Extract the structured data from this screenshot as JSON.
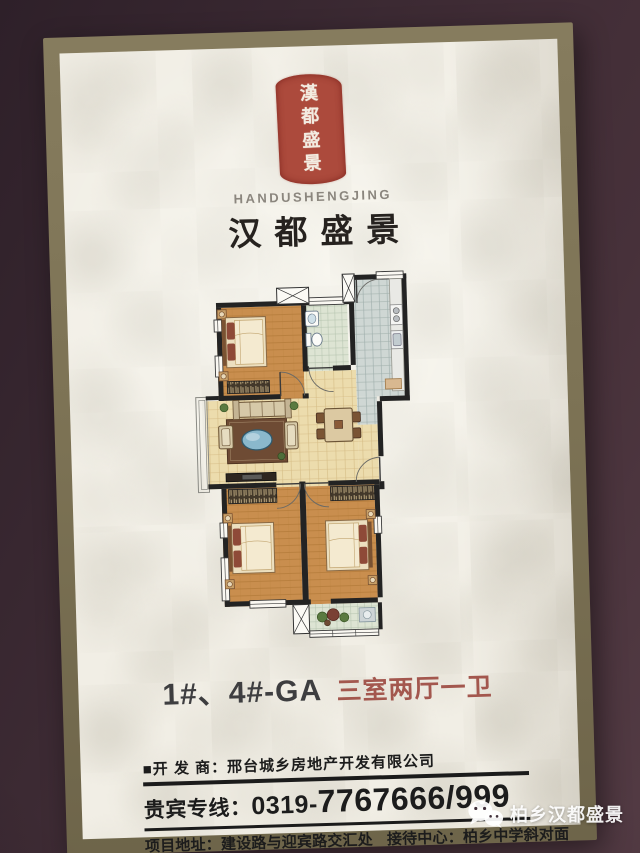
{
  "photo": {
    "background_color": "#3c2a33",
    "frame_color": "#7d7355",
    "paper_color": "#f1eee5"
  },
  "brand": {
    "seal_characters": [
      "漢",
      "都",
      "盛",
      "景"
    ],
    "seal_color": "#b04a3c",
    "latin_name": "HANDUSHENGJING",
    "calligraphy_name": "汉都盛景"
  },
  "unit": {
    "unit_label": "1#、4#-GA",
    "layout_label": "三室两厅一卫",
    "layout_color": "#a3574e"
  },
  "contact": {
    "developer_label": "■开 发 商：",
    "developer_name": "邢台城乡房地产开发有限公司",
    "hotline_label": "贵宾专线：",
    "hotline_area_code": "0319-",
    "hotline_number": "7767666/999",
    "address_label": "项目地址：",
    "address_value": "建设路与迎宾路交汇处",
    "reception_label": "接待中心：",
    "reception_value": "柏乡中学斜对面"
  },
  "watermark": {
    "icon": "wechat-icon",
    "text": "柏乡汉都盛景"
  },
  "floorplan": {
    "rooms": [
      "master-bedroom",
      "bathroom",
      "kitchen",
      "living-room",
      "dining-area",
      "bedroom-2",
      "bedroom-3",
      "balcony"
    ]
  }
}
